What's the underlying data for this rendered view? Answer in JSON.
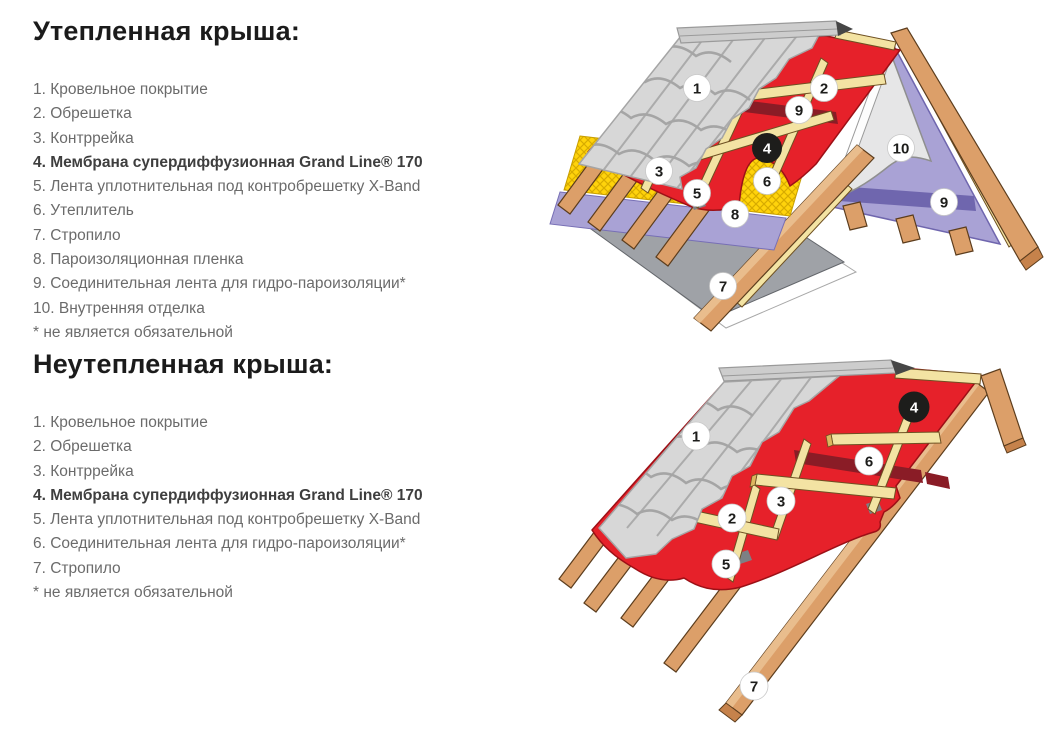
{
  "sections": {
    "insulated": {
      "title": "Утепленная крыша:",
      "items": [
        "1. Кровельное покрытие",
        "2. Обрешетка",
        "3. Контррейка",
        "4. Мембрана супердиффузионная Grand Line® 170",
        "5. Лента уплотнительная под контробрешетку X-Band",
        "6. Утеплитель",
        "7. Стропило",
        "8. Пароизоляционная пленка",
        "9. Соединительная лента для гидро-пароизоляции*",
        "10. Внутренняя отделка"
      ],
      "footnote": "* не является обязательной"
    },
    "cold": {
      "title": "Неутепленная крыша:",
      "items": [
        "1. Кровельное покрытие",
        "2. Обрешетка",
        "3. Контррейка",
        "4. Мембрана супердиффузионная Grand Line® 170",
        "5. Лента уплотнительная под контробрешетку X-Band",
        "6. Соединительная лента для гидро-пароизоляции*",
        "7. Стропило"
      ],
      "footnote": "* не является обязательной"
    }
  },
  "diagrams": {
    "insulated": {
      "callouts": [
        "1",
        "2",
        "9",
        "4",
        "3",
        "5",
        "6",
        "8",
        "7",
        "10",
        "9"
      ]
    },
    "cold": {
      "callouts": [
        "1",
        "4",
        "6",
        "3",
        "2",
        "5",
        "7"
      ]
    }
  },
  "colors": {
    "membrane_red": "#e6212a",
    "tape_dark_red": "#8a1c26",
    "insulation_yellow": "#ffd30b",
    "vapor_barrier_purple": "#a9a2d5",
    "connection_tape_purple": "#6f66ae",
    "xband_tape_gray": "#7d8084",
    "wood_rafter": "#dc9f69",
    "wood_batten": "#f3e3a3",
    "metal_tile_gray": "#d7d7d7",
    "interior_panel_gray": "#e6e6e7",
    "heading_black": "#1b1b1b",
    "text_gray": "#6b6b6b"
  }
}
